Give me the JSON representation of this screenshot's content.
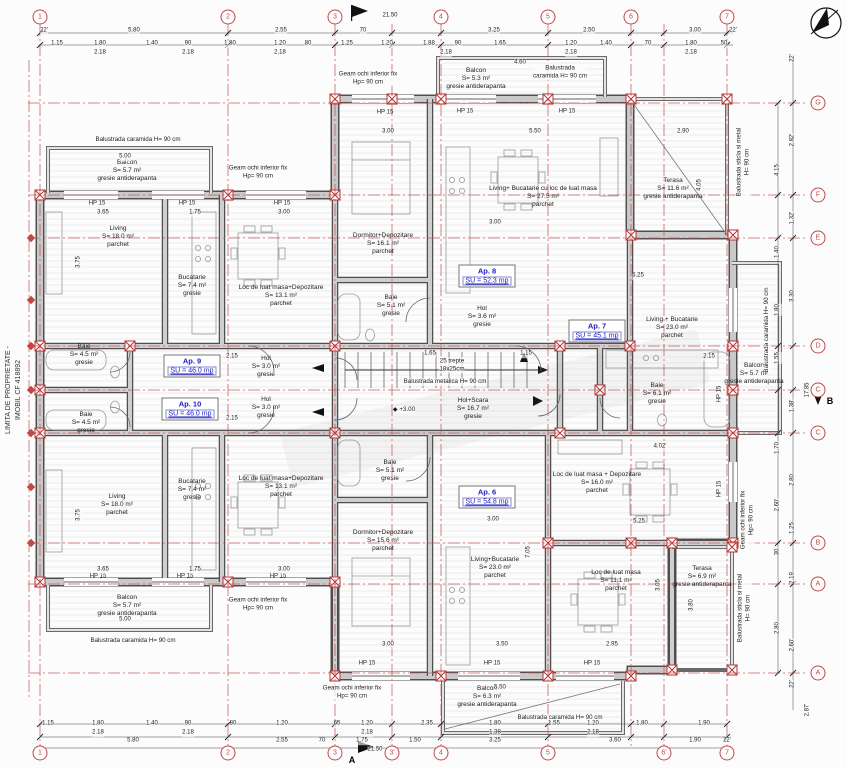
{
  "side_text": {
    "line1": "LIMITA DE PROPRIETATE -",
    "line2": "IMOBIL CF 418892"
  },
  "apartments": [
    {
      "name": "Ap. 9",
      "su": "SU = 46.0 mp",
      "x": 192,
      "y": 366
    },
    {
      "name": "Ap. 10",
      "su": "SU = 46.0 mp",
      "x": 190,
      "y": 409
    },
    {
      "name": "Ap. 8",
      "su": "SU = 52.3 mp",
      "x": 487,
      "y": 276
    },
    {
      "name": "Ap. 7",
      "su": "SU = 45.1 mp",
      "x": 597,
      "y": 331
    },
    {
      "name": "Ap. 6",
      "su": "SU = 54.8 mp",
      "x": 487,
      "y": 497
    }
  ],
  "rooms": [
    {
      "lines": [
        "Living",
        "S= 18.0 m²",
        "parchet"
      ],
      "x": 118,
      "y": 237
    },
    {
      "lines": [
        "Bucatarie",
        "S= 7.4 m²",
        "gresie"
      ],
      "x": 192,
      "y": 286
    },
    {
      "lines": [
        "Loc de luat masa+Depozitare",
        "S= 13.1 m²",
        "parchet"
      ],
      "x": 281,
      "y": 296
    },
    {
      "lines": [
        "Baie",
        "S= 4.5 m²",
        "gresie"
      ],
      "x": 84,
      "y": 355
    },
    {
      "lines": [
        "Hol",
        "S= 3.0 m²",
        "gresie"
      ],
      "x": 266,
      "y": 367
    },
    {
      "lines": [
        "Hol",
        "S= 3.0 m²",
        "gresie"
      ],
      "x": 266,
      "y": 408
    },
    {
      "lines": [
        "Baie",
        "S= 4.5 m²",
        "gresie"
      ],
      "x": 86,
      "y": 423
    },
    {
      "lines": [
        "Bucatarie",
        "S= 7.4 m²",
        "gresie"
      ],
      "x": 192,
      "y": 490
    },
    {
      "lines": [
        "Living",
        "S= 18.0 m²",
        "parchet"
      ],
      "x": 117,
      "y": 505
    },
    {
      "lines": [
        "Loc de luat masa+Depozitare",
        "S= 13.1 m²",
        "parchet"
      ],
      "x": 281,
      "y": 487
    },
    {
      "lines": [
        "Dormitor+Depozitare",
        "S= 16.1 m²",
        "parchet"
      ],
      "x": 383,
      "y": 244
    },
    {
      "lines": [
        "Living+ Bucatarie cu loc de luat masa",
        "S= 27.5 m²",
        "parchet"
      ],
      "x": 543,
      "y": 197
    },
    {
      "lines": [
        "Baie",
        "S= 5.1 m²",
        "gresie"
      ],
      "x": 391,
      "y": 306
    },
    {
      "lines": [
        "Hol",
        "S= 3.6 m²",
        "gresie"
      ],
      "x": 482,
      "y": 317
    },
    {
      "lines": [
        "Hol+Scara",
        "S= 16.7 m²",
        "gresie"
      ],
      "x": 473,
      "y": 409
    },
    {
      "lines": [
        "Living + Bucatarie",
        "S= 23.0 m²",
        "parchet"
      ],
      "x": 672,
      "y": 328
    },
    {
      "lines": [
        "Baie",
        "S= 6.1 m²",
        "gresie"
      ],
      "x": 657,
      "y": 394
    },
    {
      "lines": [
        "Loc de luat masa + Depozitare",
        "S= 16.0 m²",
        "parchet"
      ],
      "x": 597,
      "y": 483
    },
    {
      "lines": [
        "Dormitor+Depozitare",
        "S= 15.6 m²",
        "parchet"
      ],
      "x": 383,
      "y": 541
    },
    {
      "lines": [
        "Living+Bucatarie",
        "S= 23.0 m²",
        "parchet"
      ],
      "x": 495,
      "y": 568
    },
    {
      "lines": [
        "Baie",
        "S= 5.1 m²",
        "gresie"
      ],
      "x": 390,
      "y": 471
    },
    {
      "lines": [
        "Loc de luat masa",
        "S= 11.1 m²",
        "parchet"
      ],
      "x": 616,
      "y": 581
    },
    {
      "lines": [
        "Terasa",
        "S= 11.6 m²",
        "gresie antiderapanta"
      ],
      "x": 673,
      "y": 189
    },
    {
      "lines": [
        "Terasa",
        "S= 6.9 m²",
        "gresie antiderapanta"
      ],
      "x": 702,
      "y": 577
    },
    {
      "lines": [
        "Balcon",
        "S= 5.7 m²",
        "gresie antiderapanta"
      ],
      "x": 127,
      "y": 171
    },
    {
      "lines": [
        "Balcon",
        "S= 5.3 m²",
        "gresie antiderapanta"
      ],
      "x": 476,
      "y": 79
    },
    {
      "lines": [
        "Balcon",
        "S= 5.7 m²",
        "gresie antiderapanta"
      ],
      "x": 127,
      "y": 606
    },
    {
      "lines": [
        "Balcon",
        "S= 6.3 m²",
        "gresie antiderapanta"
      ],
      "x": 487,
      "y": 697
    },
    {
      "lines": [
        "Balcon",
        "S= 5.7 m²",
        "gresie antiderapanta"
      ],
      "x": 754,
      "y": 374
    }
  ],
  "annotations": [
    {
      "lines": [
        "Geam ochi inferior fix",
        "Hp= 90 cm"
      ],
      "x": 368,
      "y": 78
    },
    {
      "lines": [
        "Geam ochi inferior fix",
        "Hp= 90 cm"
      ],
      "x": 258,
      "y": 172
    },
    {
      "lines": [
        "Geam ochi inferior fix",
        "Hp= 90 cm"
      ],
      "x": 258,
      "y": 604
    },
    {
      "lines": [
        "Geam ochi inferior fix",
        "Hp= 90 cm"
      ],
      "x": 352,
      "y": 692
    },
    {
      "lines": [
        "Geam ochi inferior fix",
        "Hp= 90 cm"
      ],
      "x": 747,
      "y": 520,
      "v": true
    },
    {
      "lines": [
        "Balustrada caramida H= 90 cm"
      ],
      "x": 138,
      "y": 140
    },
    {
      "lines": [
        "Balustrada",
        "caramida H= 90 cm"
      ],
      "x": 560,
      "y": 72
    },
    {
      "lines": [
        "Balustrada caramida H= 90 cm"
      ],
      "x": 133,
      "y": 641
    },
    {
      "lines": [
        "Balustrada caramida H= 90 cm"
      ],
      "x": 560,
      "y": 718
    },
    {
      "lines": [
        "Balustrada caramida H= 90 cm"
      ],
      "x": 767,
      "y": 330,
      "v": true
    },
    {
      "lines": [
        "Balustrada sticla si metal",
        "H= 90 cm"
      ],
      "x": 743,
      "y": 162,
      "v": true
    },
    {
      "lines": [
        "Balustrada sticla si metal",
        "H= 90 cm"
      ],
      "x": 744,
      "y": 608,
      "v": true
    },
    {
      "lines": [
        "Balustrada metalica H= 90 cm"
      ],
      "x": 445,
      "y": 382
    },
    {
      "lines": [
        "25 trepte",
        "18x25cm"
      ],
      "x": 452,
      "y": 365
    },
    {
      "lines": [
        "◆ +3.00"
      ],
      "x": 404,
      "y": 410
    }
  ],
  "windows": {
    "label": "HP 15",
    "positions": [
      [
        97,
        204
      ],
      [
        187,
        204
      ],
      [
        282,
        204
      ],
      [
        385,
        113
      ],
      [
        465,
        112
      ],
      [
        567,
        112
      ],
      [
        98,
        577
      ],
      [
        185,
        577
      ],
      [
        278,
        577
      ],
      [
        367,
        664
      ],
      [
        492,
        664
      ],
      [
        592,
        664
      ]
    ],
    "vertical_positions": [
      [
        720,
        394
      ],
      [
        720,
        489
      ]
    ]
  },
  "grid": {
    "top": [
      {
        "label": "1",
        "x": 40
      },
      {
        "label": "2",
        "x": 228
      },
      {
        "label": "3",
        "x": 335
      },
      {
        "label": "4",
        "x": 441
      },
      {
        "label": "5",
        "x": 548
      },
      {
        "label": "6",
        "x": 631
      },
      {
        "label": "7",
        "x": 727
      }
    ],
    "bottom": [
      {
        "label": "1",
        "x": 40
      },
      {
        "label": "2",
        "x": 228
      },
      {
        "label": "3",
        "x": 335
      },
      {
        "label": "3'",
        "x": 392
      },
      {
        "label": "4",
        "x": 441
      },
      {
        "label": "5",
        "x": 548
      },
      {
        "label": "6'",
        "x": 664
      },
      {
        "label": "7",
        "x": 727
      }
    ],
    "right": [
      {
        "label": "G",
        "y": 103
      },
      {
        "label": "F",
        "y": 195
      },
      {
        "label": "E",
        "y": 238
      },
      {
        "label": "D",
        "y": 346
      },
      {
        "label": "C",
        "y": 390
      },
      {
        "label": "C",
        "y": 433
      },
      {
        "label": "B",
        "y": 543
      },
      {
        "label": "A",
        "y": 584
      },
      {
        "label": "A",
        "y": 673
      }
    ],
    "left_marker_ys": [
      238,
      300,
      346,
      390,
      433,
      487,
      543
    ]
  },
  "dimensions": {
    "top": [
      [
        "21.50",
        390,
        16
      ],
      [
        "22'",
        44,
        31
      ],
      [
        "5.80",
        134,
        31
      ],
      [
        "2.55",
        281,
        31
      ],
      [
        "70",
        363,
        31
      ],
      [
        "3.25",
        494,
        31
      ],
      [
        "2.50",
        589,
        31
      ],
      [
        "3.00",
        695,
        31
      ],
      [
        "22'",
        733,
        31
      ],
      [
        "1.15",
        57,
        44
      ],
      [
        "1.80",
        100,
        44
      ],
      [
        "1.40",
        152,
        44
      ],
      [
        "90",
        188,
        44
      ],
      [
        "1.80",
        230,
        44
      ],
      [
        "1.20",
        280,
        44
      ],
      [
        "80",
        308,
        44
      ],
      [
        "1.25",
        347,
        44
      ],
      [
        "1.20",
        387,
        44
      ],
      [
        "1.88",
        429,
        44
      ],
      [
        "90",
        458,
        44
      ],
      [
        "1.65",
        500,
        44
      ],
      [
        "1.20",
        571,
        44
      ],
      [
        "1.40",
        606,
        44
      ],
      [
        "70",
        648,
        44
      ],
      [
        "1.80",
        691,
        44
      ],
      [
        "50",
        724,
        44
      ],
      [
        "2.18",
        100,
        53
      ],
      [
        "2.18",
        188,
        53
      ],
      [
        "2.18",
        280,
        53
      ],
      [
        "2.18",
        446,
        53
      ],
      [
        "2.18",
        571,
        53
      ],
      [
        "2.18",
        691,
        53
      ]
    ],
    "bottom": [
      [
        "1.15",
        48,
        724
      ],
      [
        "1.80",
        98,
        724
      ],
      [
        "1.40",
        152,
        724
      ],
      [
        "90",
        188,
        724
      ],
      [
        "80",
        233,
        724
      ],
      [
        "1.20",
        282,
        724
      ],
      [
        "65",
        337,
        724
      ],
      [
        "1.20",
        367,
        724
      ],
      [
        "2.35",
        427,
        724
      ],
      [
        "1.80",
        495,
        724
      ],
      [
        "1.55",
        554,
        724
      ],
      [
        "1.20",
        593,
        724
      ],
      [
        "1.80",
        642,
        724
      ],
      [
        "1.90",
        704,
        724
      ],
      [
        "2.18",
        98,
        733
      ],
      [
        "2.18",
        188,
        733
      ],
      [
        "2.18",
        367,
        733
      ],
      [
        "1.38",
        495,
        733
      ],
      [
        "2.18",
        593,
        733
      ],
      [
        "5.80",
        133,
        741
      ],
      [
        "2.55",
        282,
        741
      ],
      [
        "70",
        322,
        741
      ],
      [
        "1.75",
        362,
        741
      ],
      [
        "1.50",
        415,
        741
      ],
      [
        "3.25",
        495,
        741
      ],
      [
        "3.60",
        615,
        741
      ],
      [
        "1.90",
        695,
        741
      ],
      [
        "22'",
        727,
        741
      ],
      [
        "21.50",
        375,
        750
      ]
    ],
    "right": [
      [
        "22'",
        793,
        58
      ],
      [
        "2.82'",
        793,
        140
      ],
      [
        "4.15",
        778,
        170
      ],
      [
        "1.32'",
        793,
        218
      ],
      [
        "1.40",
        778,
        252
      ],
      [
        "3.30",
        793,
        296
      ],
      [
        "1.80",
        778,
        310
      ],
      [
        "1.55",
        778,
        358
      ],
      [
        "17.85",
        808,
        390
      ],
      [
        "1.38'",
        793,
        406
      ],
      [
        "1.70",
        778,
        448
      ],
      [
        "2.80",
        793,
        480
      ],
      [
        "2.60'",
        778,
        505
      ],
      [
        "1.25",
        793,
        528
      ],
      [
        "30",
        778,
        552
      ],
      [
        "2.19",
        793,
        578
      ],
      [
        "2.80",
        778,
        628
      ],
      [
        "2.60'",
        793,
        645
      ],
      [
        "22'",
        793,
        684
      ],
      [
        "2.87'",
        808,
        710
      ]
    ],
    "interior": [
      [
        "3.65",
        103,
        213
      ],
      [
        "1.75",
        195,
        213
      ],
      [
        "3.00",
        284,
        213
      ],
      [
        "3.65",
        103,
        570
      ],
      [
        "1.75",
        195,
        570
      ],
      [
        "3.00",
        284,
        570
      ],
      [
        "3.00",
        388,
        132
      ],
      [
        "5.50",
        535,
        132
      ],
      [
        "3.00",
        495,
        223
      ],
      [
        "2.90",
        683,
        132
      ],
      [
        "5.25",
        638,
        276
      ],
      [
        "5.25",
        639,
        522
      ],
      [
        "4.02'",
        660,
        447
      ],
      [
        "5.00",
        125,
        157
      ],
      [
        "5.00",
        125,
        620
      ],
      [
        "4.60",
        520,
        63
      ],
      [
        "5.50",
        500,
        688
      ],
      [
        "3.00",
        493,
        520
      ],
      [
        "3.00",
        388,
        645
      ],
      [
        "3.50",
        502,
        645
      ],
      [
        "2.95",
        612,
        645
      ],
      [
        "1.65",
        430,
        354
      ],
      [
        "1.15",
        526,
        354
      ],
      [
        "2.15",
        232,
        357
      ],
      [
        "2.15",
        232,
        419
      ],
      [
        "2.15",
        709,
        357
      ],
      [
        "3.75",
        79,
        262,
        "v"
      ],
      [
        "3.75",
        79,
        515,
        "v"
      ],
      [
        "4.05",
        700,
        185,
        "v"
      ],
      [
        "3.80",
        692,
        605,
        "v"
      ],
      [
        "7.05",
        529,
        552,
        "v"
      ],
      [
        "3.05",
        659,
        585,
        "v"
      ]
    ]
  },
  "sections": [
    {
      "text": "A",
      "x": 352,
      "y": 760
    },
    {
      "text": "B",
      "x": 830,
      "y": 401
    }
  ],
  "colors": {
    "grid_red": "#c04848",
    "wall_dark": "#4f4f4f",
    "wall_fill": "#c9c9c9",
    "apartment_blue": "#1a1ac8",
    "line_black": "#2a2a2a"
  }
}
